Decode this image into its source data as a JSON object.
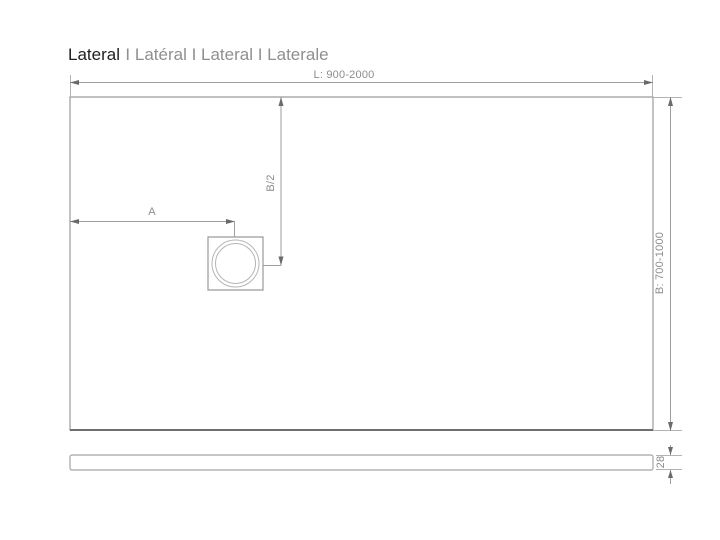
{
  "title": {
    "primary": "Lateral",
    "secondary": "I Latéral I Lateral I Laterale"
  },
  "dimensions": {
    "length": "L: 900-2000",
    "width": "B: 700-1000",
    "drain_offset": "A",
    "drain_center": "B/2",
    "tray_thickness": "28"
  },
  "colors": {
    "dimension_line_gray": "#9e9e9e",
    "outline_gray": "#8f8f8f",
    "dark_edge_gray": "#6f6f6f",
    "circle_gray": "#b5b5b5",
    "text_gray": "#8c8c8c",
    "title_dark": "#1f1f1f"
  }
}
